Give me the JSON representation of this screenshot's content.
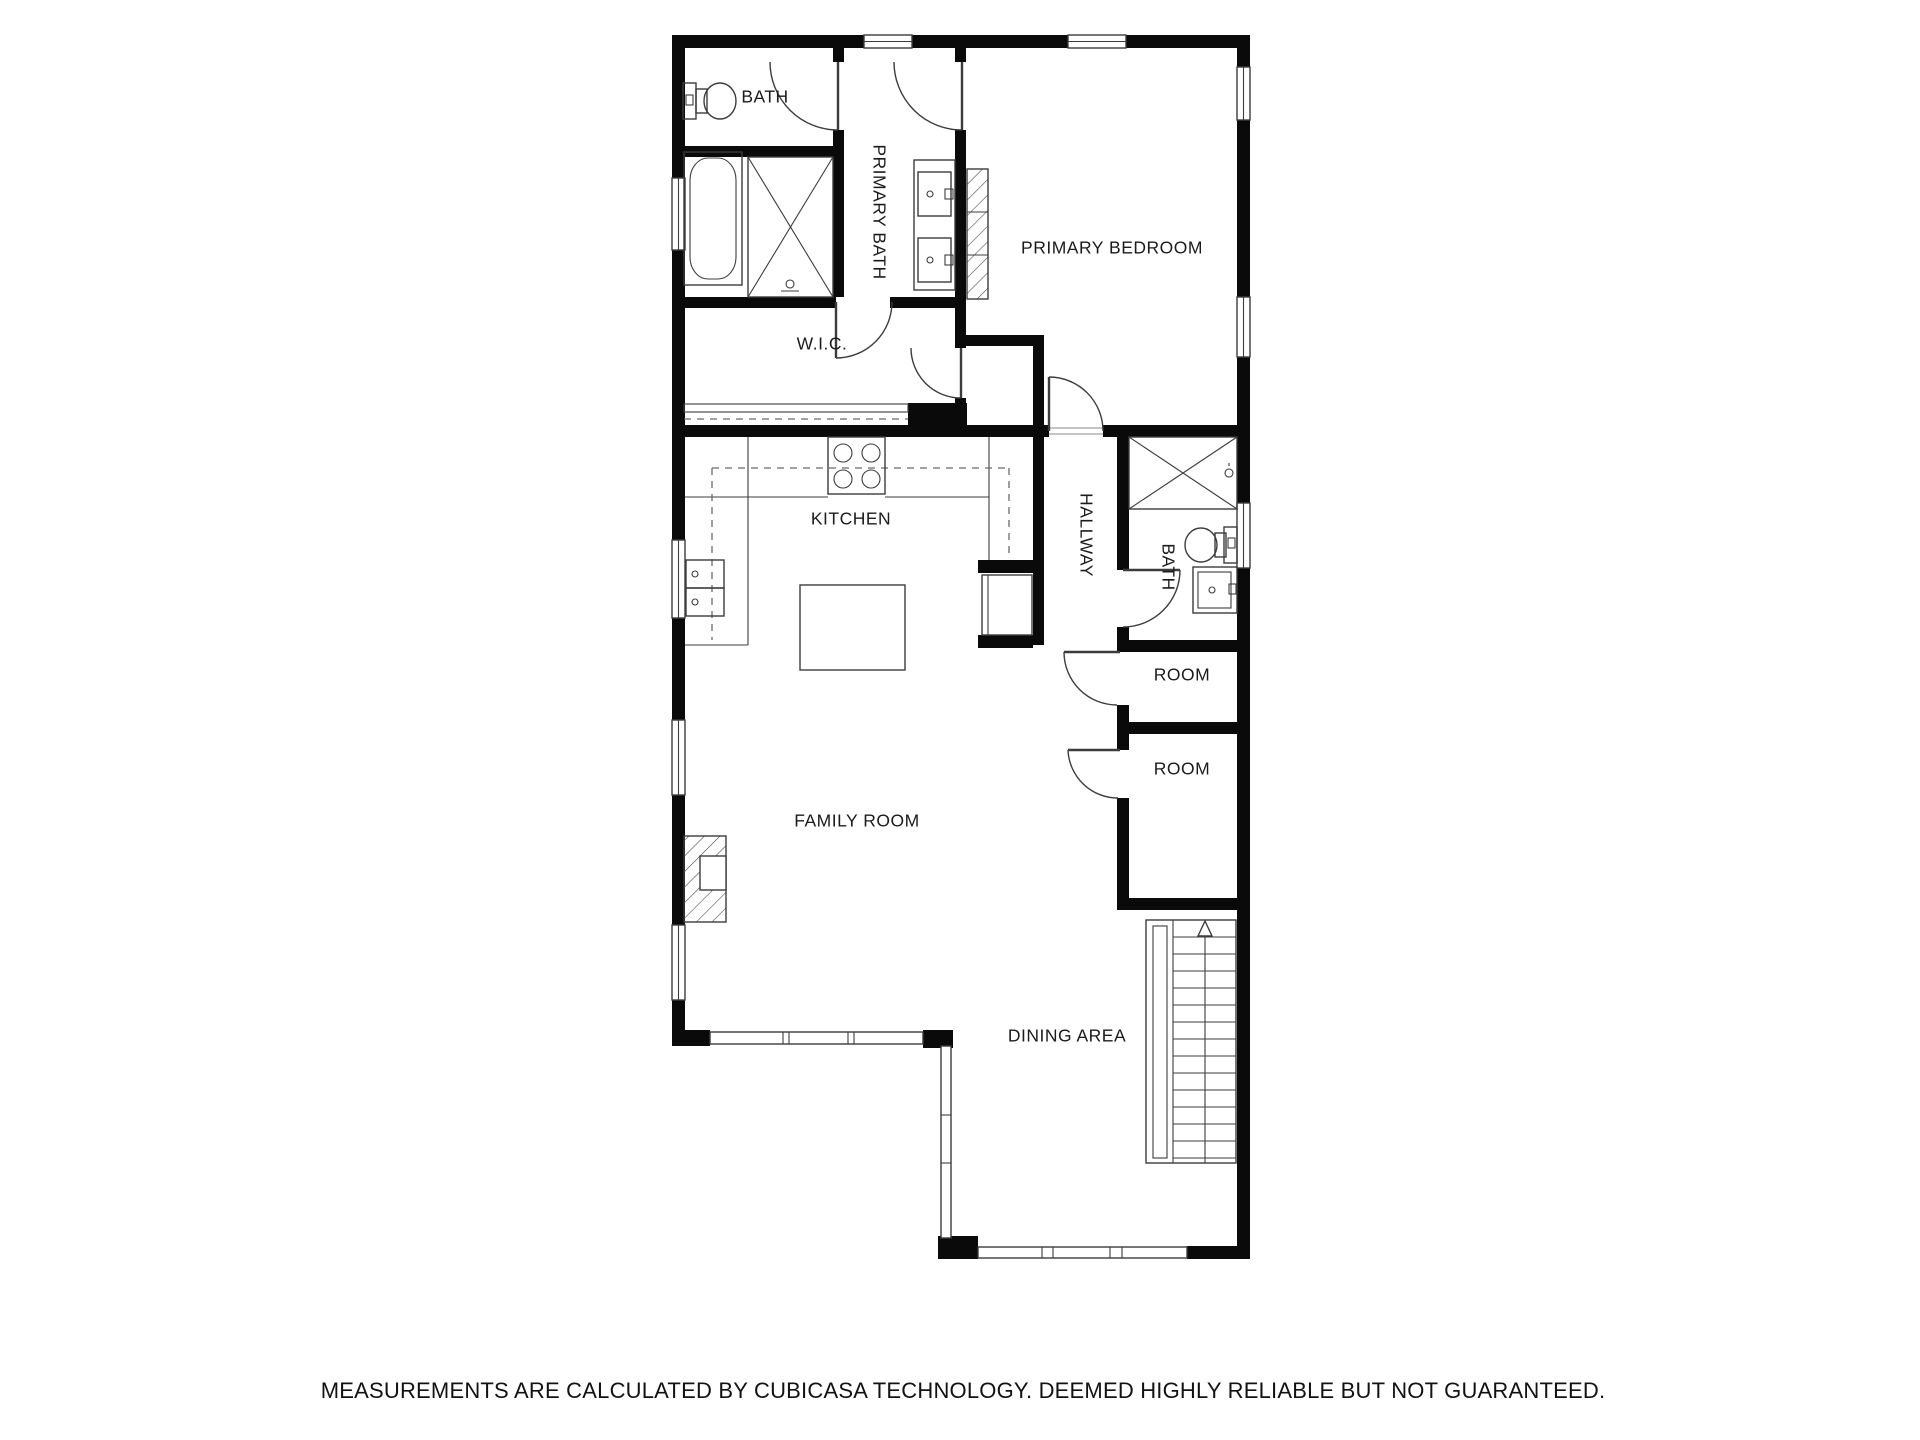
{
  "colors": {
    "walls": "#0a0a0a",
    "lines": "#3c3c3c",
    "background": "#ffffff"
  },
  "rooms": {
    "bath_upper": "BATH",
    "primary_bath": "PRIMARY BATH",
    "primary_bedroom": "PRIMARY BEDROOM",
    "wic": "W.I.C.",
    "kitchen": "KITCHEN",
    "hallway": "HALLWAY",
    "bath_hallway": "BATH",
    "room_1": "ROOM",
    "room_2": "ROOM",
    "family_room": "FAMILY ROOM",
    "dining_area": "DINING AREA"
  },
  "footer": {
    "disclaimer": "MEASUREMENTS ARE CALCULATED BY CUBICASA TECHNOLOGY. DEEMED HIGHLY RELIABLE BUT NOT GUARANTEED."
  }
}
